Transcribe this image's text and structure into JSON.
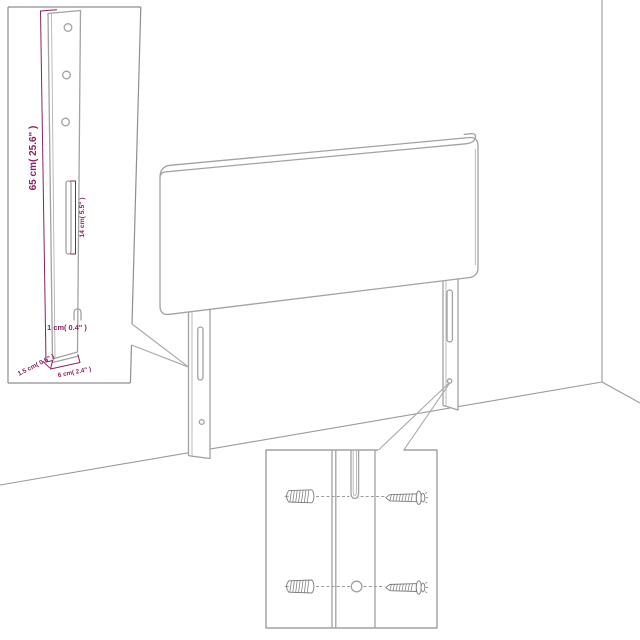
{
  "colors": {
    "background": "#ffffff",
    "line_art": "#a2a2a2",
    "inset_border": "#8f8f8f",
    "dimension": "#8a2162"
  },
  "scene": {
    "elements": [
      "headboard-panel",
      "left-leg",
      "right-leg",
      "wall-corner",
      "floor-lines"
    ]
  },
  "leg_inset": {
    "labels": {
      "leg_height": "65 cm( 25.6\" )",
      "slot_length": "14 cm( 5.5\" )",
      "hook_slot": "1 cm( 0.4\" )",
      "leg_thickness": "1.5 cm( 0.6\" )",
      "leg_width": "6 cm( 2.4\" )"
    },
    "features": {
      "screw_holes": 3,
      "slots": 1
    }
  },
  "hardware_inset": {
    "icons": {
      "anchor": "wall-plug-icon",
      "screw": "screw-icon"
    },
    "counts": {
      "wall_plugs": 2,
      "screws": 2,
      "mounting_holes": 1,
      "mounting_slots": 1
    }
  }
}
